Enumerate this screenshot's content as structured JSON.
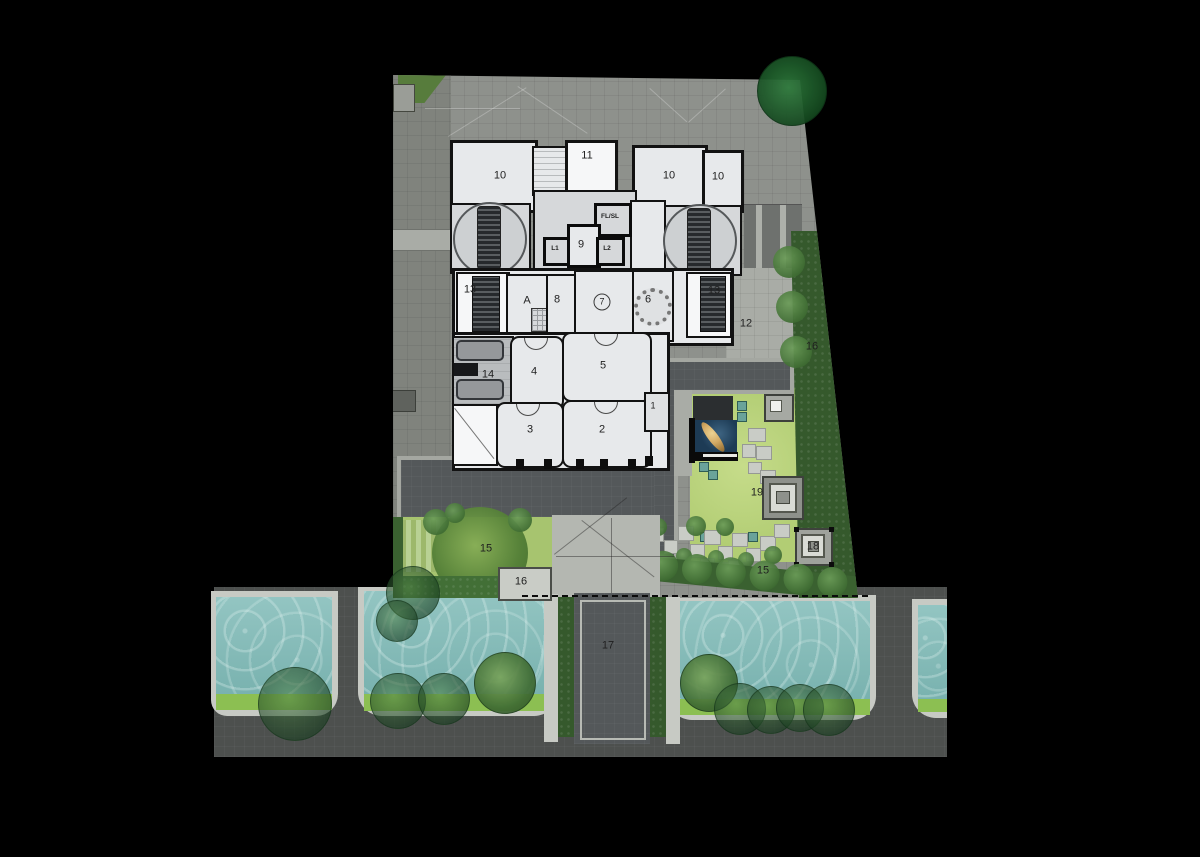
{
  "plan_type": "architectural-site-plan",
  "rooms": {
    "ten_a": "10",
    "eleven": "11",
    "ten_b": "10",
    "ten_c": "10",
    "fl_sl": "FL/SL",
    "l1": "L1",
    "nine": "9",
    "l2": "L2",
    "thirteen_a": "13",
    "a_unit": "A",
    "eight": "8",
    "seven": "7",
    "six": "6",
    "thirteen_b": "13",
    "twelve": "12",
    "fourteen": "14",
    "four": "4",
    "five": "5",
    "one": "1",
    "two": "2",
    "three": "3",
    "fifteen_west": "15",
    "fifteen_east": "15",
    "sixteen_hedge": "16",
    "sixteen_gate": "16",
    "seventeen": "17",
    "eighteen": "18",
    "nineteen": "19"
  },
  "colors": {
    "background": "#000000",
    "paving": "#8e918c",
    "paving-dark": "#80837d",
    "paving-light": "#a9aca6",
    "wall": "#121212",
    "room": "#e7e9eb",
    "room-white": "#f6f7f8",
    "pad": "#d6d8da",
    "band": "#54585a",
    "band-edge": "#a4a7a1",
    "road": "#4d504e",
    "sidewalk": "#c7cac4",
    "water": "#85bcb9",
    "pool-green": "#8cbf52",
    "lawn": "#b2cd74",
    "hedge": "#35592c",
    "bush": "#4e7c3e",
    "bush-light": "#609150",
    "pond": "#1d3b55",
    "sculpture-gold": "#d2a964",
    "tree-dark": "#1d5a2b"
  }
}
